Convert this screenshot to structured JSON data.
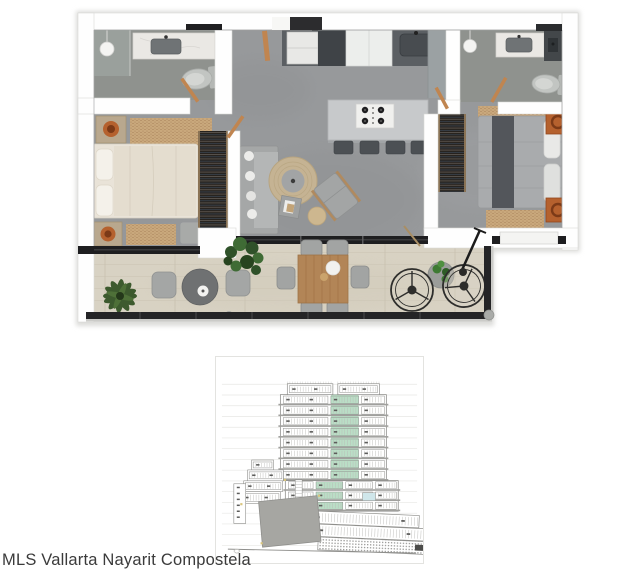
{
  "caption": {
    "text": "MLS Vallarta Nayarit Compostela",
    "color": "#3b3b3b"
  },
  "palette": {
    "wall": "#fefefe",
    "wall_edge": "#d9d9d6",
    "concrete_floor": "#97999b",
    "bathroom_floor": "#8f928e",
    "terrace_floor": "#d8d2c3",
    "track_black": "#1e1e20",
    "counter_dark": "#5b5f63",
    "island_gray": "#c7c9cb",
    "marble": "#eae8e4",
    "closet_dark": "#26221e",
    "bed_cream": "#e9e3d8",
    "bed_gray": "#a9abad",
    "runner_dark": "#53565b",
    "rug_tan": "#c9a87c",
    "sofa_gray": "#a5a7a7",
    "accent_orange": "#b5612e",
    "plant_green": "#355427",
    "wood_table": "#b28557",
    "railing_dark": "#242426"
  },
  "floor_plan": {
    "rooms": [
      "bathroom-1",
      "bedroom-1",
      "entry",
      "kitchen",
      "living-room",
      "bathroom-2",
      "bedroom-2",
      "terrace"
    ],
    "furniture": [
      "shower",
      "vanity-sink",
      "toilet",
      "double-bed",
      "nightstand",
      "closet",
      "kitchen-island",
      "gas-cooktop",
      "bar-stools",
      "fridge",
      "kitchen-sink",
      "sofa",
      "round-rug",
      "lounge-chair",
      "side-table",
      "pouf",
      "dining-table",
      "dining-chairs",
      "bistro-set",
      "papasan-chairs",
      "potted-palm",
      "fiddle-leaf-plant",
      "plant-table",
      "floor-lamp"
    ]
  },
  "building_section": {
    "colors": {
      "line": "#8f8f8c",
      "mullion": "#b9b9b6",
      "datum": "#e7e7e4",
      "highlight": "#badec6",
      "label": "#5c5c5a",
      "slab": "#a0a09d",
      "mass": "#a6a6a2",
      "accent": "#d9c57d",
      "blue": "#cfe6ea",
      "dark": "#4c4c4a",
      "light": "#c9c9c6"
    },
    "datum": {
      "x1": 6,
      "x2": 203,
      "top": 27.5,
      "step": 10.85,
      "count": 16
    },
    "penthouse": {
      "blocks": [
        [
          72,
          27,
          46,
          11
        ],
        [
          123,
          27,
          42,
          11
        ]
      ]
    },
    "tower": {
      "x": 65,
      "w": 107,
      "top": 38,
      "row_h": 10.85,
      "floors": 8,
      "groups": [
        [
          68,
          113
        ],
        [
          116,
          144
        ],
        [
          147,
          170
        ]
      ],
      "green_group": 1
    },
    "podium": {
      "x": 70,
      "w": 114,
      "top": 124.8,
      "row_h": 10.3,
      "floors": 3,
      "groups": [
        [
          73,
          98
        ],
        [
          101,
          128
        ],
        [
          131,
          158
        ],
        [
          161,
          182
        ]
      ],
      "green_index": 1,
      "blue_cell": [
        148,
        137,
        13,
        8
      ]
    },
    "wings": [
      [
        36,
        104,
        22,
        10
      ],
      [
        32,
        114,
        36,
        11
      ],
      [
        28,
        125,
        39,
        11
      ],
      [
        25,
        136,
        40,
        12
      ],
      [
        18,
        128,
        12,
        40
      ]
    ],
    "core": {
      "x": 80,
      "y": 124,
      "w": 7,
      "h": 64
    },
    "lower_rows": [
      [
        95,
        155.5,
        110,
        12.5
      ],
      [
        99,
        168.5,
        112,
        12.5
      ]
    ],
    "hatch_row": [
      104,
      181.5,
      112,
      13
    ],
    "mass": [
      [
        43,
        146
      ],
      [
        102,
        140
      ],
      [
        106,
        186
      ],
      [
        47,
        192
      ]
    ],
    "accents": [
      [
        68.5,
        123
      ],
      [
        45,
        187
      ],
      [
        103,
        139
      ],
      [
        24.5,
        147.5
      ]
    ],
    "ground": {
      "x1": 12,
      "y1": 194,
      "x2": 202,
      "y2": 198
    }
  }
}
